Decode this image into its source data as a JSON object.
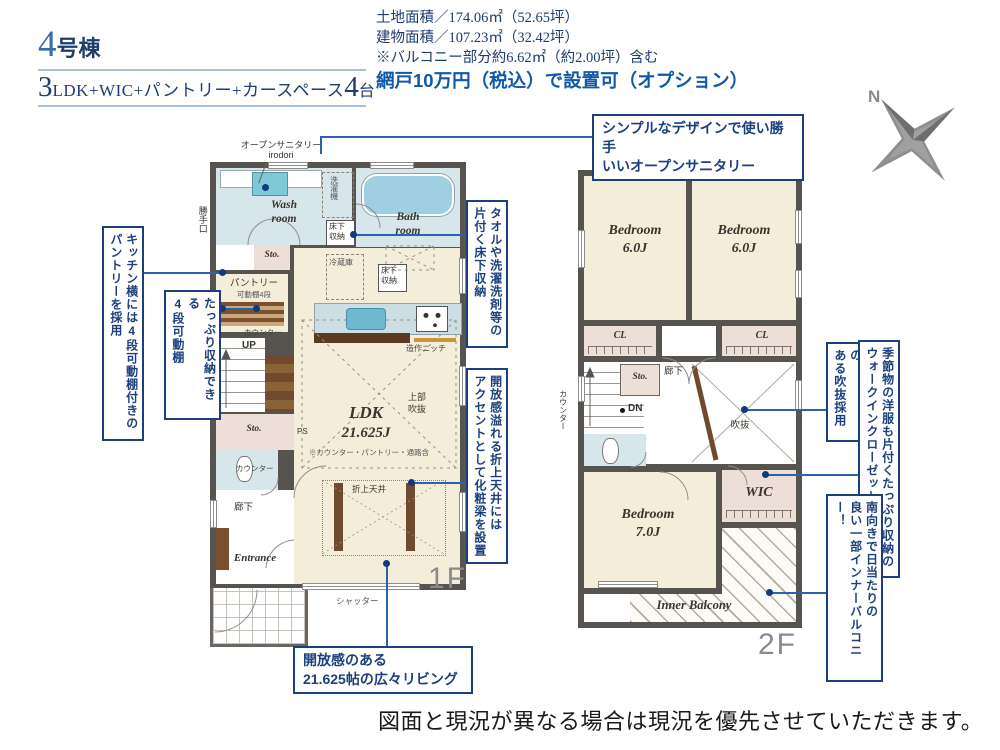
{
  "header": {
    "building_no": "4",
    "building_suffix": "号棟",
    "layout_no": "3",
    "layout_text": "LDK+WIC+パントリー+カースペース",
    "layout_cars": "4",
    "layout_unit": "台"
  },
  "areas": {
    "land": "土地面積／174.06㎡（52.65坪）",
    "building": "建物面積／107.23㎡（32.42坪）",
    "balcony_note": "※バルコニー部分約6.62㎡（約2.00坪）含む",
    "screen_option": "網戸10万円（税込）で設置可（オプション）"
  },
  "compass": {
    "north": "N"
  },
  "callouts": {
    "sanitary": "シンプルなデザインで使い勝手\nいいオープンサニタリー",
    "pantry": "キッチン横には4段可動棚付きの\nパントリーを採用",
    "shelf": "たっぷり収納できる\n4段可動棚",
    "floor_storage": "タオルや洗濯洗剤等の\n片付く床下収納",
    "ceiling": "開放感溢れる折上天井には\nアクセントとして化粧梁を設置",
    "void": "明るく開放感の\nある吹抜採用",
    "wic": "季節物の洋服も片付くたっぷり収納の\nウォークインクローゼットを設置",
    "balcony": "南向きで日当たりの\n良い一部インナーバルコニー！",
    "living": "開放感のある\n21.625帖の広々リビング"
  },
  "f1": {
    "label": "1F",
    "open_sanitary": "オープンサニタリー\nirodori",
    "kitchen_door": "勝手口",
    "wash_room": "Wash\nroom",
    "bath_room": "Bath\nroom",
    "laundry": "洗濯機",
    "floor_storage_wash": "床下\n収納",
    "sto": "Sto.",
    "pantry": "パントリー",
    "shelf4": "可動棚4段",
    "fridge": "冷蔵庫",
    "floor_storage_kitchen": "床下\n収納",
    "up": "UP",
    "counter": "カウンター",
    "niche": "造作ニッチ",
    "ldk": "LDK",
    "ldk_size": "21.625J",
    "ldk_note": "※カウンター・パントリー・通路含",
    "upper_void": "上部\n吹抜",
    "sto2": "Sto.",
    "ps": "PS",
    "counter2": "カウンター",
    "hall": "廊下",
    "entrance": "Entrance",
    "ceiling": "折上天井",
    "shutter": "シャッター"
  },
  "f2": {
    "label": "2F",
    "bedroom1": "Bedroom\n6.0J",
    "bedroom2": "Bedroom\n6.0J",
    "cl1": "CL",
    "cl2": "CL",
    "sto": "Sto.",
    "hall": "廊下",
    "dn": "DN",
    "void": "吹抜",
    "counter": "カウンター",
    "wic": "WIC",
    "bedroom3": "Bedroom\n7.0J",
    "inner_balcony": "Inner Balcony"
  },
  "footer": {
    "disclaimer": "図面と現況が異なる場合は現況を優先させていただきます。"
  },
  "colors": {
    "accent_navy": "#1c3f7e",
    "leader_blue": "#2a63ab",
    "wall_gray": "#57534e",
    "room_cream": "#f3edda",
    "room_blue": "#d7e6ea",
    "room_pink": "#eddfd8",
    "wood_brown": "#7b5031",
    "floor_label_gray": "#8a8a8a"
  }
}
